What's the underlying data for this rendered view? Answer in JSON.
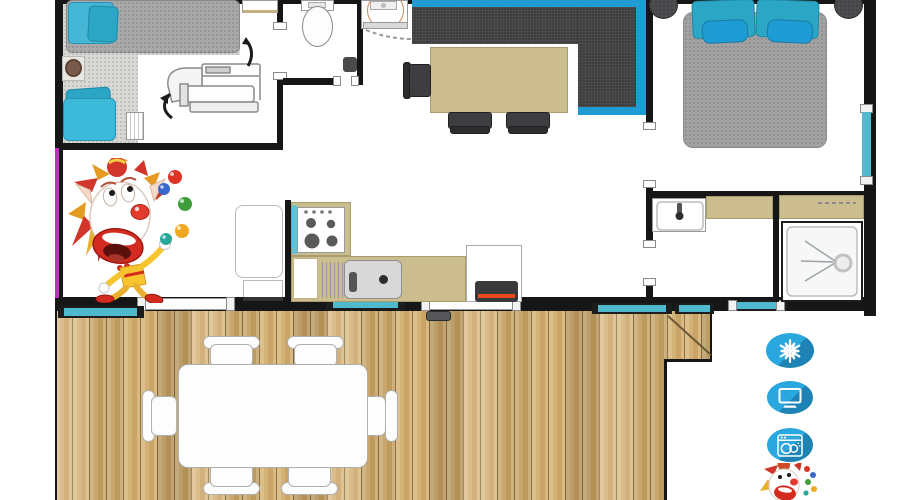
{
  "title": "mobile-home floor plan with terrace",
  "colors": {
    "wall": "#161616",
    "teal": "#2ba6c4",
    "teal_bright": "#1f9cd3",
    "teal_light": "#45b6d6",
    "teal_glass": "#4fb9ce",
    "sofa": "#3e3e40",
    "tan": "#cbbd8e",
    "tan_border": "#a89c6e",
    "wood_base": "#d2b074",
    "magenta": "#c02ec0",
    "icon_blue": "#2aa7de",
    "icon_blue_dark": "#1d83b4",
    "heater_orange": "#e8491d",
    "clown_red": "#d42b20",
    "clown_yellow": "#f6c52e"
  },
  "amenities": [
    {
      "id": "air-conditioning",
      "icon": "snowflake-icon"
    },
    {
      "id": "tv",
      "icon": "tv-icon"
    },
    {
      "id": "dishwasher",
      "icon": "dishwasher-icon"
    },
    {
      "id": "mascot",
      "icon": "clown-icon"
    }
  ],
  "rooms": [
    "kids-bedroom",
    "wc",
    "vanity-nook",
    "living-dining",
    "kitchen",
    "master-bedroom",
    "washbasin-room",
    "shower-room",
    "deck"
  ]
}
